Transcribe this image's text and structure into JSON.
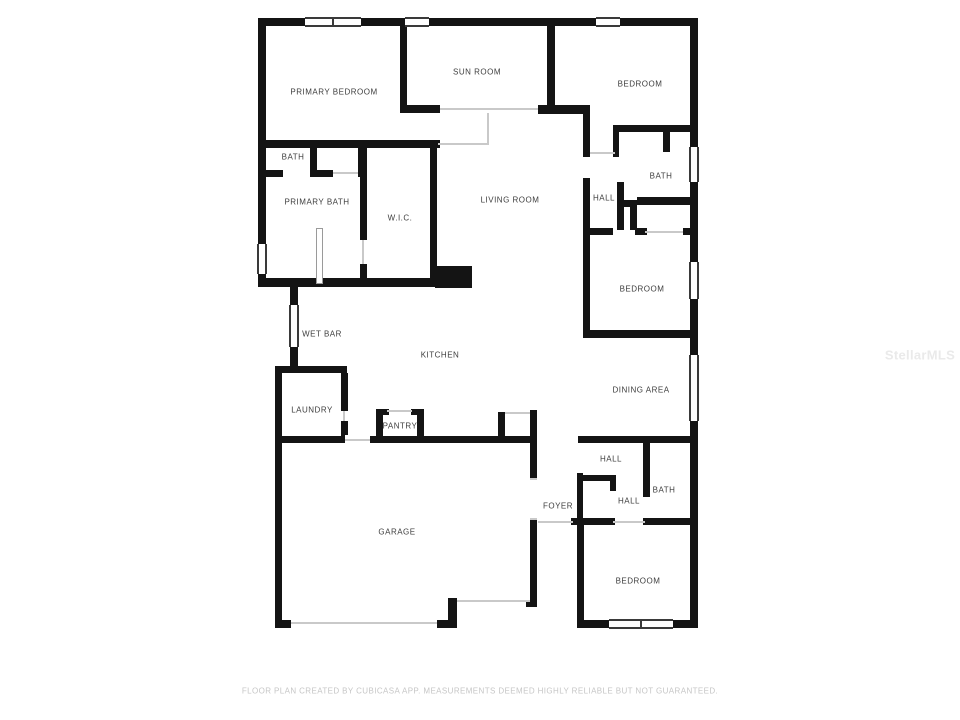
{
  "rooms": {
    "primary_bedroom": "PRIMARY BEDROOM",
    "sun_room": "SUN ROOM",
    "bedroom_top_right": "BEDROOM",
    "bath_small": "BATH",
    "primary_bath": "PRIMARY BATH",
    "wic": "W.I.C.",
    "living_room": "LIVING ROOM",
    "hall_top": "HALL",
    "bath_top_right": "BATH",
    "bedroom_mid_right": "BEDROOM",
    "wet_bar": "WET BAR",
    "kitchen": "KITCHEN",
    "dining_area": "DINING AREA",
    "laundry": "LAUNDRY",
    "pantry": "PANTRY",
    "hall_mid": "HALL",
    "foyer": "FOYER",
    "hall_lower": "HALL",
    "bath_lower": "BATH",
    "garage": "GARAGE",
    "bedroom_bottom": "BEDROOM"
  },
  "footer": {
    "disclaimer": "FLOOR PLAN CREATED BY CUBICASA APP. MEASUREMENTS DEEMED HIGHLY RELIABLE BUT NOT GUARANTEED."
  },
  "watermark": {
    "text": "StellarMLS"
  },
  "colors": {
    "wall": "#141414",
    "label": "#3d3d3d",
    "opening_line": "#c9c9c9",
    "footer_text": "#c6c6c6",
    "watermark_text": "#eaeaea",
    "background": "#ffffff"
  }
}
